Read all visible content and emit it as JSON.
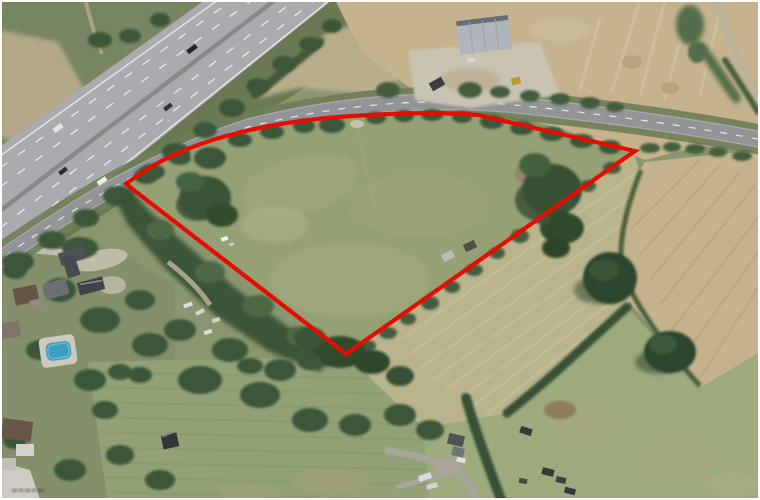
{
  "image": {
    "kind": "aerial-photograph",
    "description": "Aerial photograph of a roughly triangular land parcel outlined in red, bounded to the north by a curving A-road, with a multi-lane dual carriageway running diagonally across the top-left, harvested straw-coloured fields to the east, pasture fields to the south and a residential area with gardens and a swimming pool to the south-west.",
    "frame_color": "#ffffff"
  },
  "parcel_boundary": {
    "color": "#e60c00",
    "stroke_width": 4.2,
    "path": "M 126,184 C 180,141 262,122 352,116 C 398,113 442,112 478,115 L 635,151 L 346,354 Z"
  },
  "palette": {
    "grass_green": "#a0ab7d",
    "pale_field": "#c6c196",
    "stubble_tan": "#d3bf97",
    "tree_green": "#3f5c3c",
    "motorway_gray": "#b5b7ba",
    "road_gray": "#9c9ea1",
    "pool_blue": "#3fa9cc",
    "barn_roof": "#bcc1c8",
    "red_outline": "#e60c00"
  },
  "watermark": {
    "present": true,
    "legible": false
  }
}
